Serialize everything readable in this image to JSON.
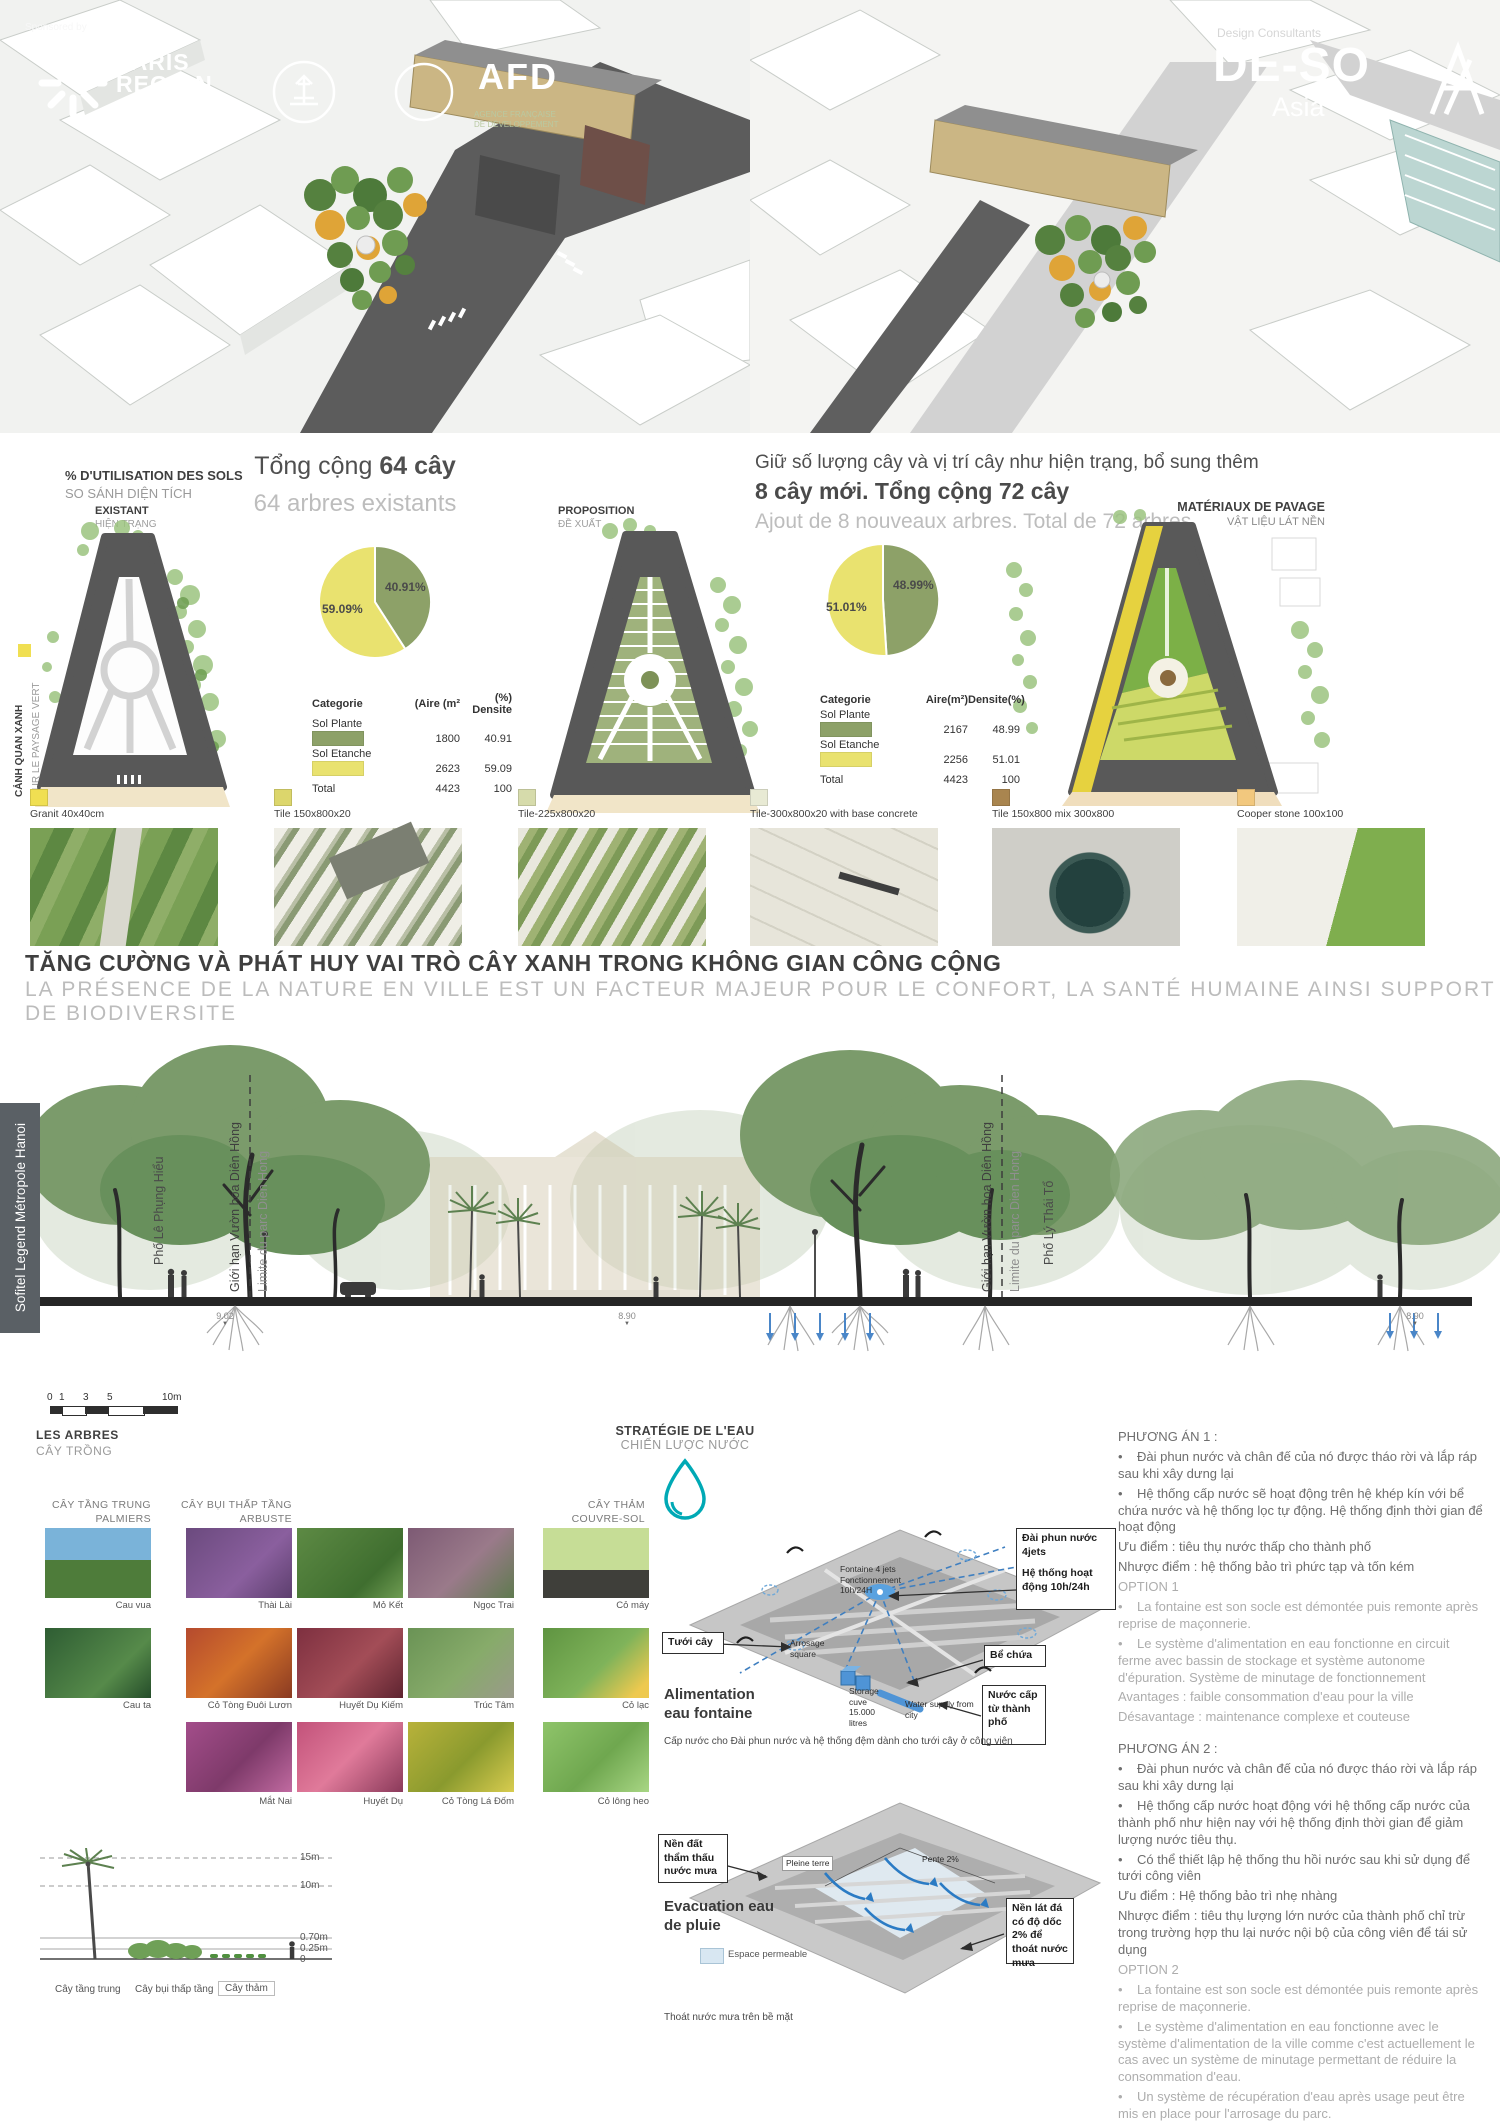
{
  "branding": {
    "sponsored_by": "Sponsored by",
    "paris_region_1": "PARIS",
    "paris_region_2": "REGION",
    "afd": "AFD",
    "afd_tag1": "AGENCE FRANÇAISE",
    "afd_tag2": "DE DÉVELOPPEMENT",
    "design_consultants": "Design Consultants",
    "deso": "DE-SO",
    "deso_sub": "Asia"
  },
  "land_use": {
    "heading_fr": "% D'UTILISATION DES SOLS",
    "heading_vi": "SO SÁNH DIỆN TÍCH",
    "side_vi": "CẢNH QUAN XANH",
    "side_fr": "SUR LE PAYSAGE VERT",
    "existing_fr": "EXISTANT",
    "existing_vi": "HIỆN TRẠNG",
    "proposed_fr": "PROPOSITION",
    "proposed_vi": "ĐỀ XUẤT",
    "paving_fr": "MATÉRIAUX DE PAVAGE",
    "paving_vi": "VẬT LIỆU LÁT NỀN",
    "existing_headline": "Tổng cộng ",
    "existing_headline_bold": "64 cây",
    "existing_sub": "64 arbres existants",
    "proposed_line1": "Giữ số lượng cây và vị trí cây như hiện trạng, bổ sung thêm",
    "proposed_line2": "8 cây mới. Tổng cộng 72 cây",
    "proposed_sub": "Ajout de 8 nouveaux arbres. Total de 72 arbres"
  },
  "chart_data": [
    {
      "type": "pie",
      "title": "Existant — % d'utilisation des sols",
      "labels": [
        "Sol Plante",
        "Sol Etanche"
      ],
      "values": [
        40.91,
        59.09
      ],
      "display": [
        "40.91%",
        "59.09%"
      ],
      "colors": [
        "#8da168",
        "#e9e26f"
      ],
      "table": {
        "headers": [
          "Categorie",
          "(Aire (m²",
          "(%) Densite"
        ],
        "rows": [
          [
            "Sol Plante",
            "1800",
            "40.91"
          ],
          [
            "Sol Etanche",
            "2623",
            "59.09"
          ],
          [
            "Total",
            "4423",
            "100"
          ]
        ]
      }
    },
    {
      "type": "pie",
      "title": "Proposition — % d'utilisation des sols",
      "labels": [
        "Sol Plante",
        "Sol Etanche"
      ],
      "values": [
        48.99,
        51.01
      ],
      "display": [
        "48.99%",
        "51.01%"
      ],
      "colors": [
        "#8da168",
        "#e9e26f"
      ],
      "table": {
        "headers": [
          "Categorie",
          "Aire(m²)",
          "Densite(%)"
        ],
        "rows": [
          [
            "Sol Plante",
            "2167",
            "48.99"
          ],
          [
            "Sol Etanche",
            "2256",
            "51.01"
          ],
          [
            "Total",
            "4423",
            "100"
          ]
        ]
      }
    }
  ],
  "materials": [
    {
      "name": "Granit 40x40cm",
      "color": "#f0df52"
    },
    {
      "name": "Tile 150x800x20",
      "color": "#dcd66c"
    },
    {
      "name": "Tile-225x800x20",
      "color": "#d6dbab"
    },
    {
      "name": "Tile-300x800x20 with base concrete",
      "color": "#e8ead4"
    },
    {
      "name": "Tile 150x800 mix 300x800",
      "color": "#a9854f"
    },
    {
      "name": "Cooper stone 100x100",
      "color": "#f2c87e"
    }
  ],
  "main_title": {
    "vi": "TĂNG CƯỜNG VÀ PHÁT HUY VAI TRÒ CÂY XANH TRONG KHÔNG GIAN CÔNG CỘNG",
    "fr": "LA PRÉSENCE DE LA NATURE EN VILLE EST UN FACTEUR MAJEUR POUR LE CONFORT, LA SANTÉ HUMAINE AINSI SUPPORT DE BIODIVERSITE"
  },
  "section": {
    "hotel": "Sofitel Legend Métropole Hanoi",
    "street_left": "Phố Lê Phụng Hiểu",
    "limit_vi": "Giới hạn Vườn hoa Diên Hồng",
    "limit_fr": "Limite du parc Dien Hong",
    "street_right": "Phố Lý Thái Tổ",
    "elev_left": "9.02",
    "elev_mid": "8.90",
    "elev_right": "8.90"
  },
  "scale_bar": {
    "t0": "0",
    "t1": "1",
    "t3": "3",
    "t5": "5",
    "t10": "10m"
  },
  "plants": {
    "title_fr": "LES ARBRES",
    "title_vi": "CÂY TRỒNG",
    "g1_vi": "CÂY TẦNG TRUNG",
    "g1_fr": "PALMIERS",
    "g2_vi": "CÂY BỤI THẤP TẦNG",
    "g2_fr": "ARBUSTE",
    "g3_vi": "CÂY THẢM",
    "g3_fr": "COUVRE-SOL",
    "palmiers": [
      "Cau vua",
      "Cau ta"
    ],
    "arbuste": [
      [
        "Thài Lài",
        "Mỏ Kết",
        "Ngọc Trai"
      ],
      [
        "Cỏ Tòng Đuôi Lươn",
        "Huyết Dụ Kiếm",
        "Trúc Tâm"
      ],
      [
        "Mắt Nai",
        "Huyết Dụ",
        "Cỏ Tòng Lá Đốm"
      ]
    ],
    "couvre_sol": [
      "Cỏ máy",
      "Cỏ lạc",
      "Cỏ lông heo"
    ]
  },
  "heights": {
    "h15": "15m",
    "h10": "10m",
    "h070": "0.70m",
    "h025": "0.25m",
    "h0": "0",
    "l1": "Cây tầng trung",
    "l2": "Cây bụi thấp tầng",
    "l3": "Cây thảm"
  },
  "water": {
    "title_fr": "STRATÉGIE DE L'EAU",
    "title_vi": "CHIẾN LƯỢC NƯỚC",
    "fountain": {
      "callout_line1": "Đài phun nước 4jets",
      "callout_line2": "Hệ thống hoạt động 10h/24h",
      "in_fontaine1": "Fontaine 4 jets",
      "in_fontaine2": "Fonctionnement 10h/24H",
      "watering_box": "Tưới cây",
      "arrosage1": "Arrosage",
      "arrosage2": "square",
      "tank_box": "Bể chứa",
      "storage1": "Storage",
      "storage2": "cuve",
      "storage3": "15.000 litres",
      "supply_box": "Nước cấp từ thành phố",
      "supply_in": "Water supply from city",
      "label1": "Alimentation",
      "label2": "eau fontaine",
      "caption": "Cấp nước cho Đài phun nước và hệ thống đệm dành cho tưới cây ở công viên"
    },
    "rain": {
      "permeable_box": "Nền đất thẩm thấu nước mưa",
      "pleine_terre": "Pleine terre",
      "pente": "Pente 2%",
      "paved_box": "Nền lát đá có độ dốc 2% để thoát nước mưa",
      "label1": "Evacuation eau",
      "label2": "de pluie",
      "legend": "Espace permeable",
      "caption": "Thoát nước mưa trên bề mặt"
    }
  },
  "options": {
    "pa1_title": "PHƯƠNG ÁN 1 :",
    "pa1": [
      "•    Đài phun nước và chân đế của nó được tháo rời và lắp ráp sau khi xây dưng lại",
      "•    Hệ thống cấp nước sẽ hoạt động trên hệ khép kín với bể chứa nước và hệ thống lọc tự động. Hệ thống định thời gian để hoạt động",
      "Ưu điểm : tiêu thụ nước thấp cho thành phố",
      "Nhược điểm : hệ thống bảo trì phức tạp và tốn kém"
    ],
    "opt1_title": "OPTION 1",
    "opt1": [
      "•    La fontaine est son socle est démontée puis remonte après reprise de maçonnerie.",
      "•    Le système d'alimentation en eau fonctionne en circuit ferme avec bassin de stockage et système autonome d'épuration. Système de minutage de fonctionnement",
      "Avantages : faible consommation d'eau pour la ville",
      "Désavantage : maintenance complexe et couteuse"
    ],
    "pa2_title": "PHƯƠNG ÁN 2 :",
    "pa2": [
      "•    Đài phun nước và chân đế của nó được tháo rời và lắp ráp sau khi xây dưng lại",
      "•    Hệ thống cấp nước hoạt động với hệ thống cấp nước của thành phố như hiện nay với hệ thống định thời gian để giảm lượng nước tiêu thụ.",
      "•    Có thể thiết lập hệ thống thu hồi nước sau khi sử dụng để tưới công viên",
      "Ưu điểm : Hệ thống bảo trì nhẹ nhàng",
      "Nhược điểm : tiêu thụ lượng lớn nước của thành phố chỉ trừ trong trường hợp thu lại nước nội bộ của công viên để tái sử dụng"
    ],
    "opt2_title": "OPTION 2",
    "opt2": [
      "•    La fontaine est son socle est démontée puis remonte après reprise de maçonnerie.",
      "•    Le système d'alimentation en eau fonctionne avec le système d'alimentation de la ville comme c'est actuellement le cas avec un système de minutage permettant de réduire la consommation d'eau.",
      "•    Un système de récupération d'eau après usage peut être mis en place pour l'arrosage du parc.",
      "Avantages : maintenance très aisée",
      "Désavantage : consommation d'eau de ville sauf si récupération pour usage interne du parc"
    ]
  }
}
